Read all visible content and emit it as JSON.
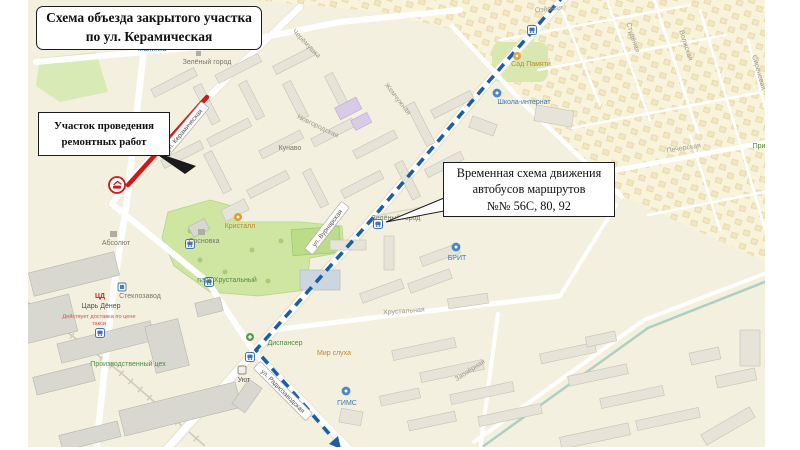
{
  "figure": {
    "title": {
      "line1": "Схема объезда закрытого участка",
      "line2": "по ул. Керамическая"
    },
    "callout_roadworks": {
      "line1": "Участок проведения",
      "line2": "ремонтных работ"
    },
    "callout_detour": {
      "line1": "Временная схема движения",
      "line2": "автобусов маршрутов",
      "line3": "№№ 56С, 80, 92"
    }
  },
  "colors": {
    "detour_route": "#1b5ea6",
    "closed_section": "#d01818"
  },
  "street_signs": {
    "keramicheskaya": "ул. Керамическая",
    "vurnarskaya": "ул. Вурнарская",
    "radiozavodskaya": "ул. Радиозаводская"
  },
  "streets": {
    "cheryomushka": "Черёмушка",
    "ozyornaya": "Озёрная",
    "zhemchuzhnaya": "Жемчужная",
    "novgorodskaya": "Новгородская",
    "studyonaya": "Студёная",
    "volzhskaya": "Волжская",
    "sirenevaya": "Сиреневая",
    "pecherskaya": "Печерская",
    "khrustalnaya": "Хрустальная",
    "zaozyornaya": "Заозёрная"
  },
  "labels": {
    "malinka": "Малинка",
    "zeleny_gorod_1": "Зелёный город",
    "sad_pamyati": "Сад Памяти",
    "shkola_internat": "Школа-интернат",
    "kunavo": "Кунаво",
    "kristall": "Кристалл",
    "sosnovka": "Сосновка",
    "absolut": "Абсолют",
    "park_khrustalny": "парк Хрустальный",
    "zeleny_gorod_2": "Зелёный город",
    "brit": "БРИТ",
    "dispanser": "Диспансер",
    "mir_slukha": "Мир слуха",
    "gims": "ГИМС",
    "uyut": "Уют",
    "steklozavod": "Стеклозавод",
    "tsar_doner_logo": "ЦД",
    "tsar_doner": "Царь Дёнер",
    "tsar_doner_note1": "Действует доставка по цене",
    "tsar_doner_note2": "такси",
    "proizvodstvenny_tsekh": "Производственный цех",
    "pribrezhnaya": "Прибрежная"
  }
}
